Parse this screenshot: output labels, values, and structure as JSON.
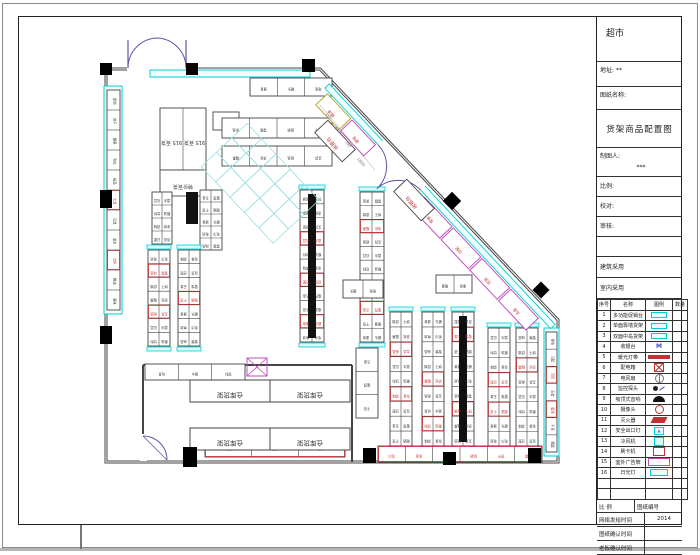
{
  "titleblock": {
    "store_name": "超市",
    "address_label": "地址:",
    "address_value": "**",
    "drawing_name_label": "图纸名称:",
    "drawing_title": "货架商品配置图",
    "drafter_label": "制图人:",
    "drafter_value": "***",
    "scale_label": "比例:",
    "proof_label": "校对:",
    "audit_label": "审核:",
    "arch_use_label": "建筑采用",
    "interior_use_label": "室内采用",
    "legend_header": [
      "序号",
      "名称",
      "图例",
      "数量"
    ],
    "legend_rows": [
      {
        "no": "1",
        "name": "多功能促销台",
        "sym": "cyanrect"
      },
      {
        "no": "2",
        "name": "单面靠墙货架",
        "sym": "cyanrect"
      },
      {
        "no": "3",
        "name": "双面中岛货架",
        "sym": "cyanrect"
      },
      {
        "no": "4",
        "name": "收银台",
        "sym": "M"
      },
      {
        "no": "5",
        "name": "暖光灯带",
        "sym": "redbar"
      },
      {
        "no": "6",
        "name": "配电箱",
        "sym": "redcross"
      },
      {
        "no": "7",
        "name": "电风扇",
        "sym": "fan"
      },
      {
        "no": "8",
        "name": "监控探头",
        "sym": "dot"
      },
      {
        "no": "9",
        "name": "吸顶式音响",
        "sym": "dome"
      },
      {
        "no": "10",
        "name": "摄像头",
        "sym": "ring"
      },
      {
        "no": "11",
        "name": "灭火器",
        "sym": "redpara"
      },
      {
        "no": "12",
        "name": "安全出口灯",
        "sym": "cyanglyph"
      },
      {
        "no": "13",
        "name": "冷风机",
        "sym": "cyanbox"
      },
      {
        "no": "14",
        "name": "刷卡机",
        "sym": "redbox"
      },
      {
        "no": "15",
        "name": "室外广告牌",
        "sym": "magentabox"
      },
      {
        "no": "16",
        "name": "日光灯",
        "sym": "cyanwide"
      },
      {
        "no": "",
        "name": "",
        "sym": "none"
      },
      {
        "no": "",
        "name": "",
        "sym": "none"
      }
    ],
    "footer": {
      "scale_label": "比 例",
      "number_label": "图纸编号",
      "rows": [
        {
          "label": "网络发给时间",
          "value": "2014"
        },
        {
          "label": "图纸确认时间",
          "value": ""
        },
        {
          "label": "老板确认时间",
          "value": ""
        }
      ]
    }
  },
  "plan": {
    "colors": {
      "wall": "#444",
      "cyan": "#00cfd6",
      "magenta": "#c24fc2",
      "red": "#c43030",
      "dim": "#777",
      "text": "#333"
    },
    "storage_label": "仓库货架",
    "checkout_label": "收银台",
    "island_labels": [
      "915 百货",
      "915 百货",
      "特价百货"
    ],
    "dim_labels": [
      "750",
      "650",
      "740",
      "1800"
    ],
    "small_labels": [
      "促销",
      "饼干",
      "糖果",
      "洗化",
      "纸品",
      "文具",
      "玩具",
      "酒水",
      "饮料",
      "粮油",
      "调味",
      "零食",
      "日配",
      "百货",
      "五金",
      "蜜饯",
      "干货",
      "烟酒",
      "速食",
      "罐头",
      "电池",
      "毛巾",
      "床品",
      "雪糕"
    ],
    "walls": {
      "outline": "106,69 320,69 558,320 558,462 106,462",
      "partitions": [
        "143,365 352,365",
        "352,365 352,462",
        "143,365 143,436"
      ]
    },
    "door_openings": [
      {
        "x": 127,
        "y": 63,
        "w": 60,
        "h": 11
      },
      {
        "x": 140,
        "y": 434,
        "w": 7,
        "h": 27
      }
    ],
    "columns": [
      [
        100,
        63,
        12,
        12
      ],
      [
        186,
        63,
        12,
        12
      ],
      [
        302,
        59,
        13,
        13
      ],
      [
        100,
        190,
        12,
        18
      ],
      [
        100,
        326,
        12,
        18
      ],
      [
        183,
        447,
        14,
        20
      ],
      [
        363,
        448,
        13,
        15
      ],
      [
        443,
        452,
        13,
        13
      ],
      [
        528,
        448,
        13,
        15
      ]
    ],
    "diamonds": [
      [
        452,
        201,
        13
      ],
      [
        541,
        290,
        12
      ]
    ],
    "bands": [
      [
        150,
        70,
        160,
        7
      ],
      [
        544,
        328,
        15,
        128
      ],
      [
        104,
        86,
        18,
        228
      ]
    ],
    "runs": [
      {
        "x": 107,
        "y": 90,
        "w": 13,
        "h": 220,
        "rows": 11,
        "cols": 1,
        "vert": true,
        "red": [
          5,
          8
        ]
      },
      {
        "x": 546,
        "y": 332,
        "w": 11,
        "h": 120,
        "rows": 7,
        "cols": 1,
        "vert": true,
        "red": [
          2,
          4
        ]
      },
      {
        "x": 160,
        "y": 108,
        "w": 46,
        "h": 62,
        "rows": 1,
        "cols": 2,
        "big": 0
      },
      {
        "x": 160,
        "y": 170,
        "w": 46,
        "h": 26,
        "rows": 1,
        "cols": 1,
        "big": 2
      },
      {
        "x": 250,
        "y": 78,
        "w": 82,
        "h": 18,
        "rows": 1,
        "cols": 3
      },
      {
        "x": 213,
        "y": 112,
        "w": 26,
        "h": 18,
        "rows": 1,
        "cols": 1
      },
      {
        "x": 222,
        "y": 118,
        "w": 110,
        "h": 20,
        "rows": 1,
        "cols": 4
      },
      {
        "x": 222,
        "y": 146,
        "w": 110,
        "h": 20,
        "rows": 1,
        "cols": 4
      },
      {
        "x": 152,
        "y": 192,
        "w": 20,
        "h": 52,
        "rows": 4,
        "cols": 2
      },
      {
        "x": 200,
        "y": 190,
        "w": 22,
        "h": 60,
        "rows": 5,
        "cols": 2
      },
      {
        "x": 300,
        "y": 190,
        "w": 24,
        "h": 152,
        "rows": 11,
        "cols": 2,
        "core": true,
        "red": [
          3,
          6,
          9
        ],
        "cap": true
      },
      {
        "x": 360,
        "y": 192,
        "w": 24,
        "h": 150,
        "rows": 11,
        "cols": 2,
        "red": [
          2,
          8
        ],
        "cap": true
      },
      {
        "x": 148,
        "y": 250,
        "w": 22,
        "h": 96,
        "rows": 7,
        "cols": 2,
        "red": [
          1,
          4
        ],
        "cap": true
      },
      {
        "x": 178,
        "y": 250,
        "w": 22,
        "h": 96,
        "rows": 7,
        "cols": 2,
        "red": [
          3
        ],
        "cap": true
      },
      {
        "x": 390,
        "y": 312,
        "w": 22,
        "h": 134,
        "rows": 9,
        "cols": 2,
        "red": [
          2,
          5
        ],
        "cap": true
      },
      {
        "x": 422,
        "y": 312,
        "w": 22,
        "h": 134,
        "rows": 9,
        "cols": 2,
        "red": [
          4,
          7
        ],
        "cap": true
      },
      {
        "x": 452,
        "y": 312,
        "w": 22,
        "h": 134,
        "rows": 9,
        "cols": 2,
        "core": true,
        "red": [
          1,
          6
        ],
        "cap": true
      },
      {
        "x": 488,
        "y": 328,
        "w": 22,
        "h": 118,
        "rows": 8,
        "cols": 2,
        "red": [
          3,
          5
        ],
        "cap": true
      },
      {
        "x": 516,
        "y": 328,
        "w": 22,
        "h": 118,
        "rows": 8,
        "cols": 2,
        "red": [
          2
        ],
        "cap": true
      },
      {
        "x": 356,
        "y": 348,
        "w": 22,
        "h": 70,
        "rows": 3,
        "cols": 1
      },
      {
        "x": 436,
        "y": 275,
        "w": 36,
        "h": 18,
        "rows": 1,
        "cols": 2
      },
      {
        "x": 343,
        "y": 280,
        "w": 40,
        "h": 18,
        "rows": 1,
        "cols": 2
      },
      {
        "x": 378,
        "y": 446,
        "w": 164,
        "h": 16,
        "rows": 1,
        "cols": 6,
        "red": [
          0
        ]
      },
      {
        "x": 205,
        "y": 437,
        "w": 140,
        "h": 20,
        "rows": 1,
        "cols": 3,
        "red": [
          0
        ]
      },
      {
        "x": 145,
        "y": 364,
        "w": 100,
        "h": 16,
        "rows": 1,
        "cols": 3
      }
    ],
    "storage_cells": [
      [
        190,
        380,
        80,
        22
      ],
      [
        270,
        380,
        80,
        22
      ],
      [
        190,
        428,
        80,
        22
      ],
      [
        270,
        428,
        80,
        22
      ]
    ],
    "xbox": [
      247,
      358,
      20,
      18
    ],
    "blackrect": [
      186,
      192,
      12,
      32
    ],
    "diag": {
      "ax": 327,
      "ay": 86,
      "angle": 46.8,
      "band_len": 330,
      "door": {
        "d": 78,
        "w": 62
      },
      "cells": [
        {
          "d": 6,
          "o": 5,
          "w": 34,
          "h": 16,
          "c": "#b9a82e"
        },
        {
          "d": 42,
          "o": 5,
          "w": 34,
          "h": 16,
          "c": "#c24fc2"
        },
        {
          "d": 148,
          "o": 5,
          "w": 40,
          "h": 17,
          "c": "#c24fc2"
        },
        {
          "d": 190,
          "o": 5,
          "w": 40,
          "h": 17,
          "c": "#c24fc2"
        },
        {
          "d": 232,
          "o": 5,
          "w": 40,
          "h": 17,
          "c": "#c24fc2"
        },
        {
          "d": 274,
          "o": 5,
          "w": 40,
          "h": 17,
          "c": "#c24fc2"
        }
      ],
      "grid": {
        "x": 253,
        "y": 118,
        "cols": 5,
        "rows": 3,
        "cell": 21
      }
    },
    "checkouts": [
      {
        "cx": 335,
        "cy": 141
      },
      {
        "cx": 414,
        "cy": 200
      }
    ],
    "dims": [
      {
        "x": 327,
        "y": 117
      },
      {
        "x": 337,
        "y": 131
      },
      {
        "x": 347,
        "y": 145
      },
      {
        "x": 360,
        "y": 163
      }
    ]
  }
}
